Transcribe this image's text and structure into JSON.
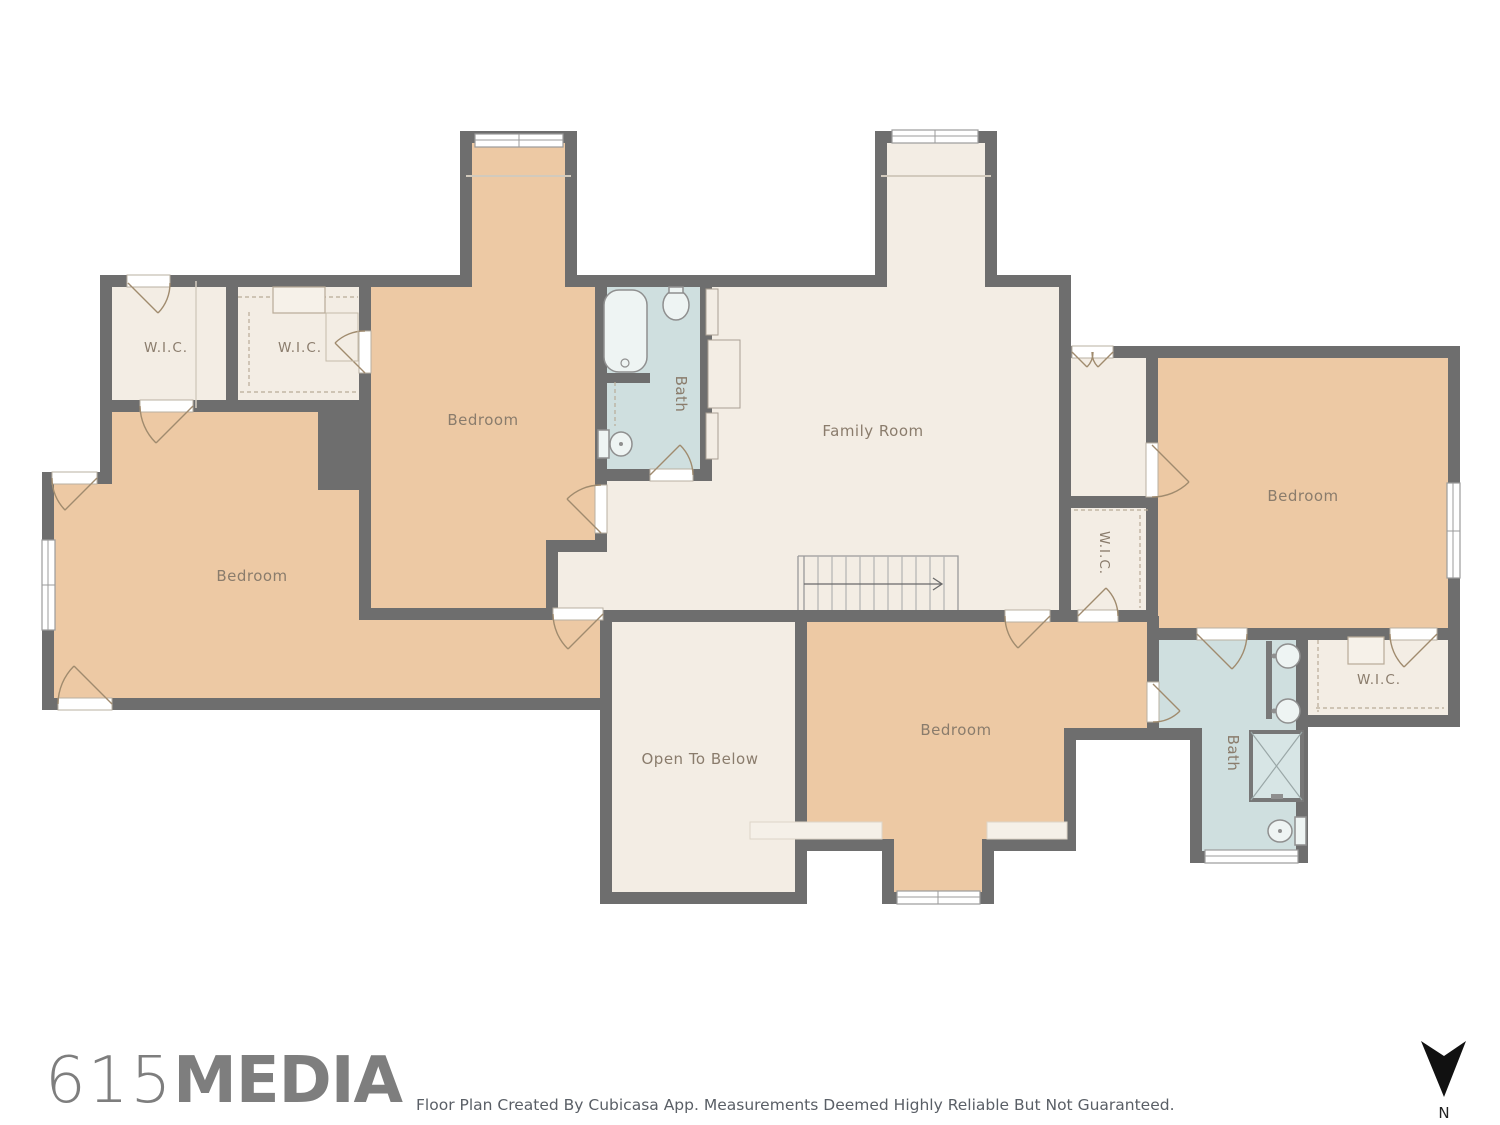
{
  "plan": {
    "rooms": {
      "wic_top_left": "W.I.C.",
      "wic_top_center": "W.I.C.",
      "bedroom_top": "Bedroom",
      "bath_top": "Bath",
      "family_room": "Family Room",
      "bedroom_left": "Bedroom",
      "hall_wic": "W.I.C.",
      "bedroom_right": "Bedroom",
      "bedroom_bottom": "Bedroom",
      "open_to_below": "Open To Below",
      "bath_bottom": "Bath",
      "wic_bottom_right": "W.I.C."
    },
    "colors": {
      "wall": "#6e6e6e",
      "room_floor": "#f3ede4",
      "bedroom_floor": "#edc9a4",
      "bath_floor": "#cfdfdf",
      "label_text": "#8a7c6c"
    }
  },
  "footer": {
    "logo_number": "615",
    "logo_word": "MEDIA",
    "disclaimer": "Floor Plan Created By Cubicasa App. Measurements Deemed Highly Reliable But Not Guaranteed."
  },
  "compass": {
    "north_label": "N"
  }
}
